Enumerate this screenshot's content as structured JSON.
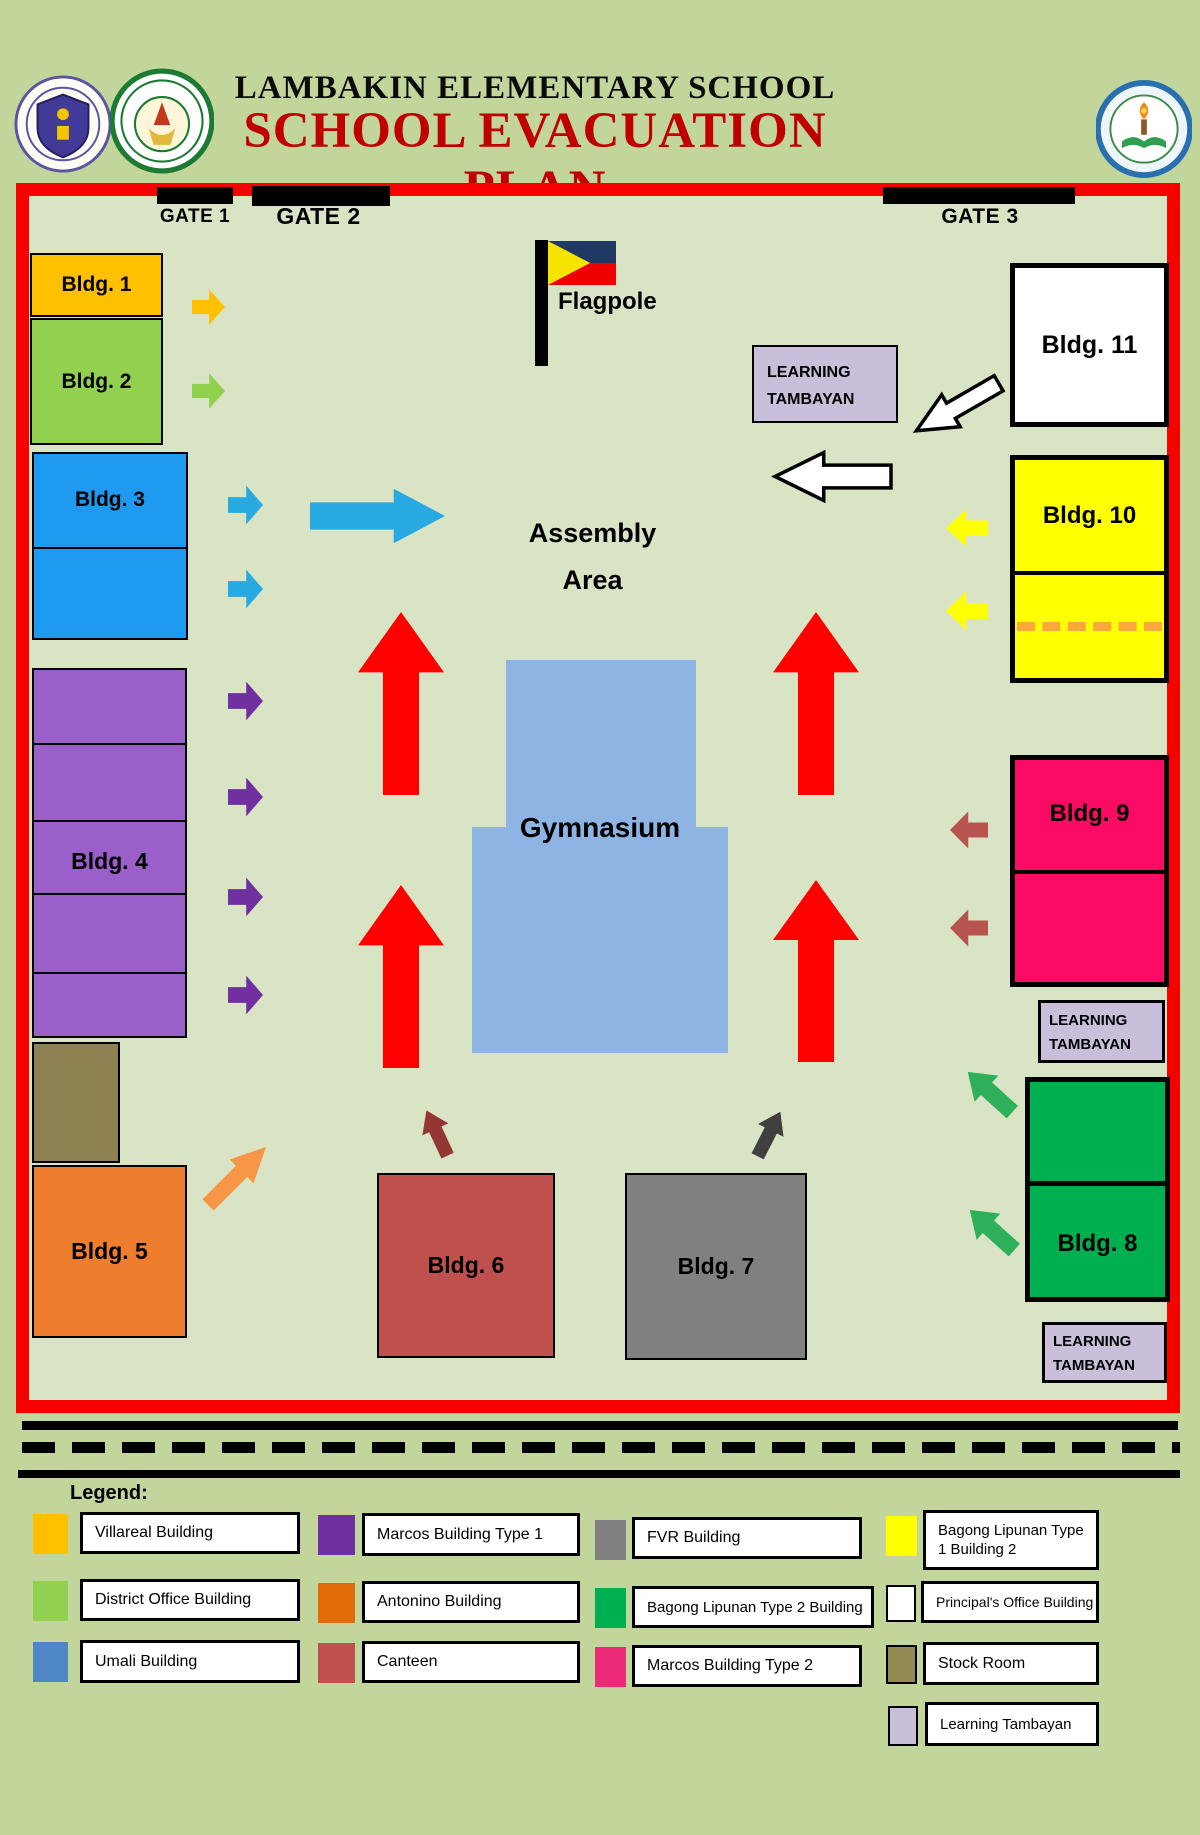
{
  "header": {
    "school_name": "LAMBAKIN ELEMENTARY SCHOOL",
    "plan_title": "SCHOOL EVACUATION PLAN",
    "plan_title_color": "#C00000",
    "logos": [
      {
        "name": "deped-seal"
      },
      {
        "name": "division-of-bulacan-seal"
      },
      {
        "name": "lambakin-elementary-school-seal"
      }
    ]
  },
  "map": {
    "border_color": "#F80000",
    "ground_color": "#D9E4C4",
    "gates": [
      {
        "label": "GATE 1"
      },
      {
        "label": "GATE 2"
      },
      {
        "label": "GATE 3"
      }
    ],
    "flagpole": {
      "label": "Flagpole",
      "flag_triangle": "#F5E400",
      "flag_top": "#1F3864",
      "flag_bottom": "#EE0000"
    },
    "assembly_area": {
      "line1": "Assembly",
      "line2": "Area"
    },
    "gymnasium": {
      "label": "Gymnasium",
      "color": "#8DB4E2"
    },
    "learning_tambayan": {
      "line1": "LEARNING",
      "line2": "TAMBAYAN",
      "color": "#C9BFDA"
    },
    "stock_room": {
      "color": "#8E8152"
    },
    "dashed_route_color": "#FFA63D",
    "buildings": {
      "b1": {
        "label": "Bldg. 1",
        "color": "#FFC000"
      },
      "b2": {
        "label": "Bldg. 2",
        "color": "#92D050"
      },
      "b3": {
        "label": "Bldg. 3",
        "color": "#1E9AF0"
      },
      "b4": {
        "label": "Bldg. 4",
        "color": "#9A5FC9"
      },
      "b5": {
        "label": "Bldg. 5",
        "color": "#EE7D2E"
      },
      "b6": {
        "label": "Bldg. 6",
        "color": "#C0504D"
      },
      "b7": {
        "label": "Bldg. 7",
        "color": "#808080"
      },
      "b8": {
        "label": "Bldg. 8",
        "color": "#00B050"
      },
      "b9": {
        "label": "Bldg. 9",
        "color": "#FA0B64"
      },
      "b10": {
        "label": "Bldg. 10",
        "color": "#FFFF00"
      },
      "b11": {
        "label": "Bldg. 11",
        "color": "#FFFFFF"
      }
    },
    "arrow_colors": {
      "assembly_red": "#FF0000",
      "villareal": "#FFC000",
      "district": "#92D050",
      "umali": "#29A9E1",
      "marcos1": "#7030A0",
      "antonino": "#F79646",
      "canteen": "#943634",
      "fvr": "#404040",
      "bagong2": "#2EB05B",
      "marcos2": "#B85450",
      "bagong1": "#FFFF00",
      "white": "#FFFFFF"
    }
  },
  "legend": {
    "title": "Legend:",
    "items": [
      {
        "label": "Villareal Building",
        "color": "#FFC000"
      },
      {
        "label": "District Office Building",
        "color": "#92D050"
      },
      {
        "label": "Umali Building",
        "color": "#4F86C6"
      },
      {
        "label": "Marcos Building Type 1",
        "color": "#7030A0"
      },
      {
        "label": "Antonino Building",
        "color": "#E36C0A"
      },
      {
        "label": "Canteen",
        "color": "#C0504D"
      },
      {
        "label": "FVR Building",
        "color": "#808080"
      },
      {
        "label": "Bagong Lipunan Type 2 Building",
        "color": "#00B050"
      },
      {
        "label": "Marcos Building Type 2",
        "color": "#EC2A78"
      },
      {
        "label": "Bagong Lipunan Type 1 Building 2",
        "color": "#FFFF00"
      },
      {
        "label": "Principal's Office Building",
        "color": "#FFFFFF"
      },
      {
        "label": "Stock Room",
        "color": "#948A54"
      },
      {
        "label": "Learning Tambayan",
        "color": "#C9BFDA"
      }
    ]
  }
}
